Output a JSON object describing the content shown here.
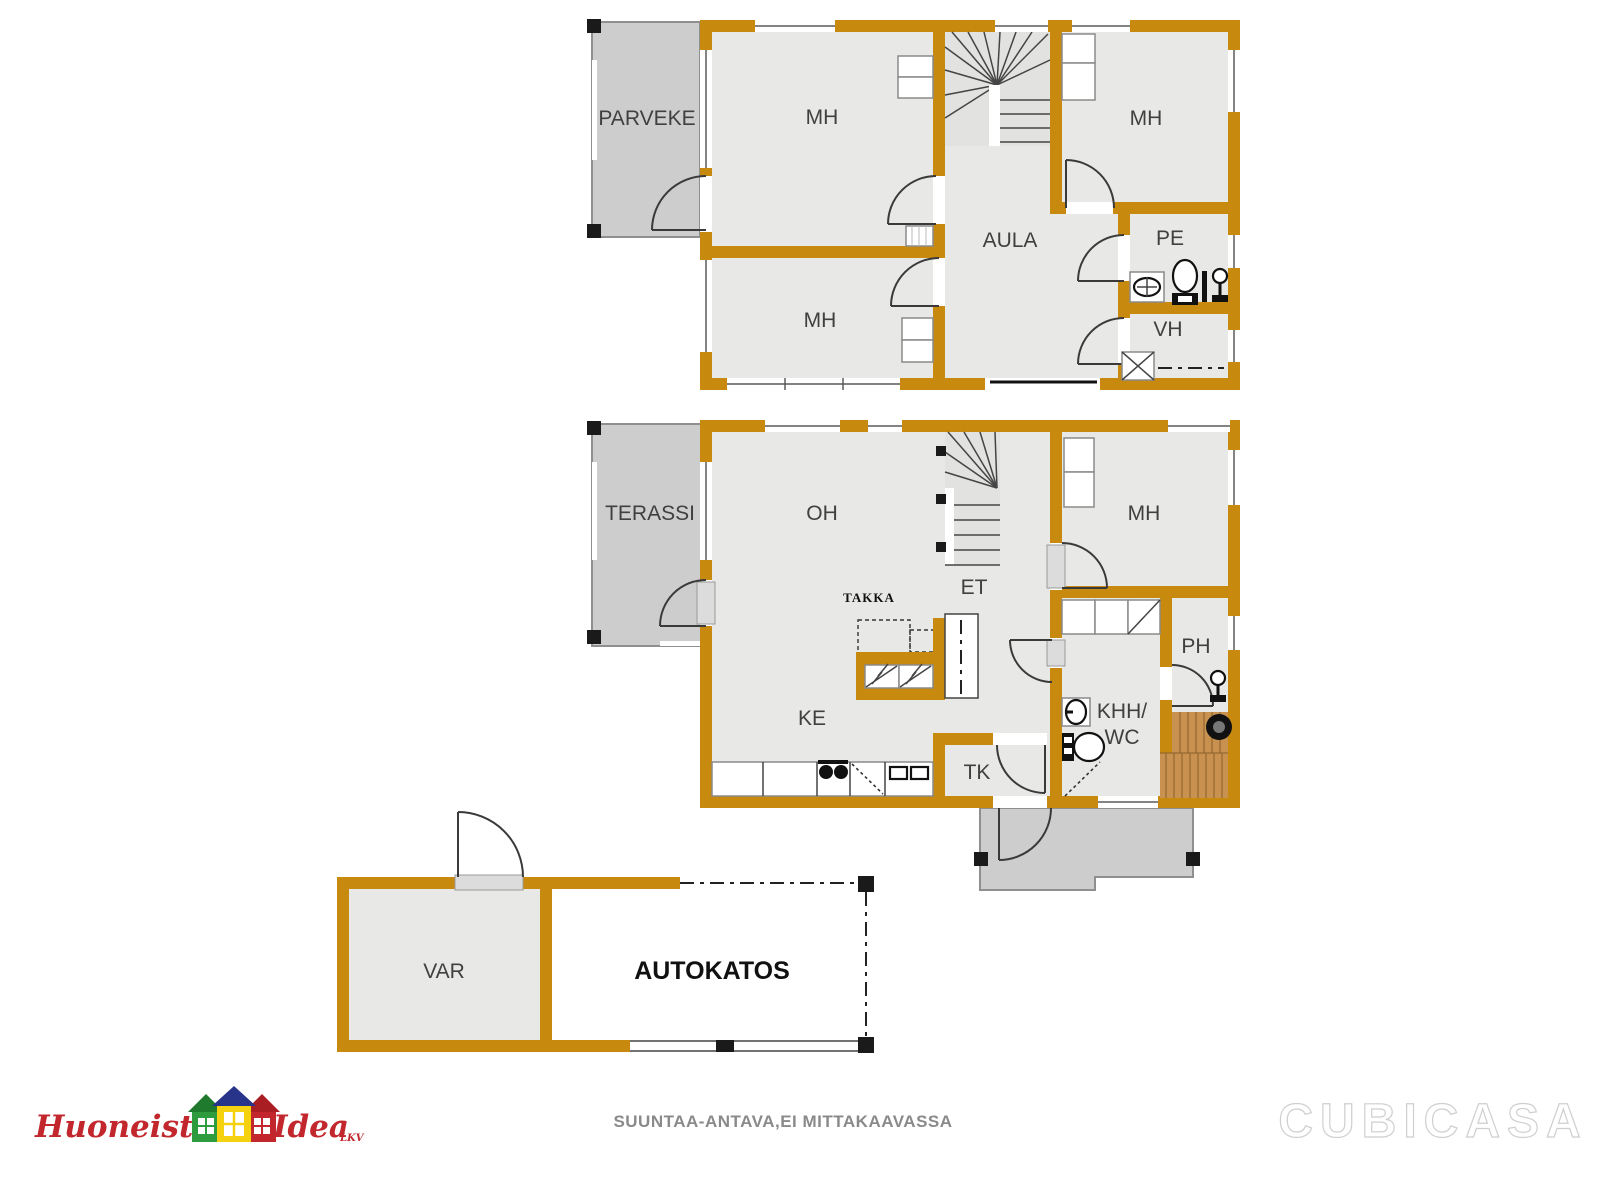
{
  "plan": {
    "type": "residential-floor-plan",
    "floors_shown": 3
  },
  "colors": {
    "wall": "#C8890F",
    "room_fill": "#E8E8E6",
    "outdoor_fill": "#CDCDCD",
    "sauna_wood": "#C89150",
    "label_text": "#404040",
    "logo_red": "#C1272D",
    "logo_green": "#2E9B3E",
    "logo_yellow": "#F5D10F",
    "logo_blue": "#28338A",
    "disclaimer_gray": "#8A8A8A"
  },
  "labels": {
    "upper": {
      "parveke": "PARVEKE",
      "mh_top_left": "MH",
      "mh_top_right": "MH",
      "mh_bottom": "MH",
      "aula": "AULA",
      "pe": "PE",
      "vh": "VH"
    },
    "main": {
      "terassi": "TERASSI",
      "oh": "OH",
      "et": "ET",
      "mh": "MH",
      "takka": "TAKKA",
      "ke": "KE",
      "tk": "TK",
      "khh_line1": "KHH/",
      "khh_line2": "WC",
      "ph": "PH"
    },
    "outbuilding": {
      "var": "VAR",
      "autokatos": "AUTOKATOS"
    }
  },
  "footer": {
    "disclaimer": "SUUNTAA-ANTAVA,EI MITTAKAAVASSA",
    "brand": "CUBICASA",
    "logo": {
      "word1": "Huoneisto",
      "word2": "Idea",
      "suffix": "LKV"
    }
  }
}
